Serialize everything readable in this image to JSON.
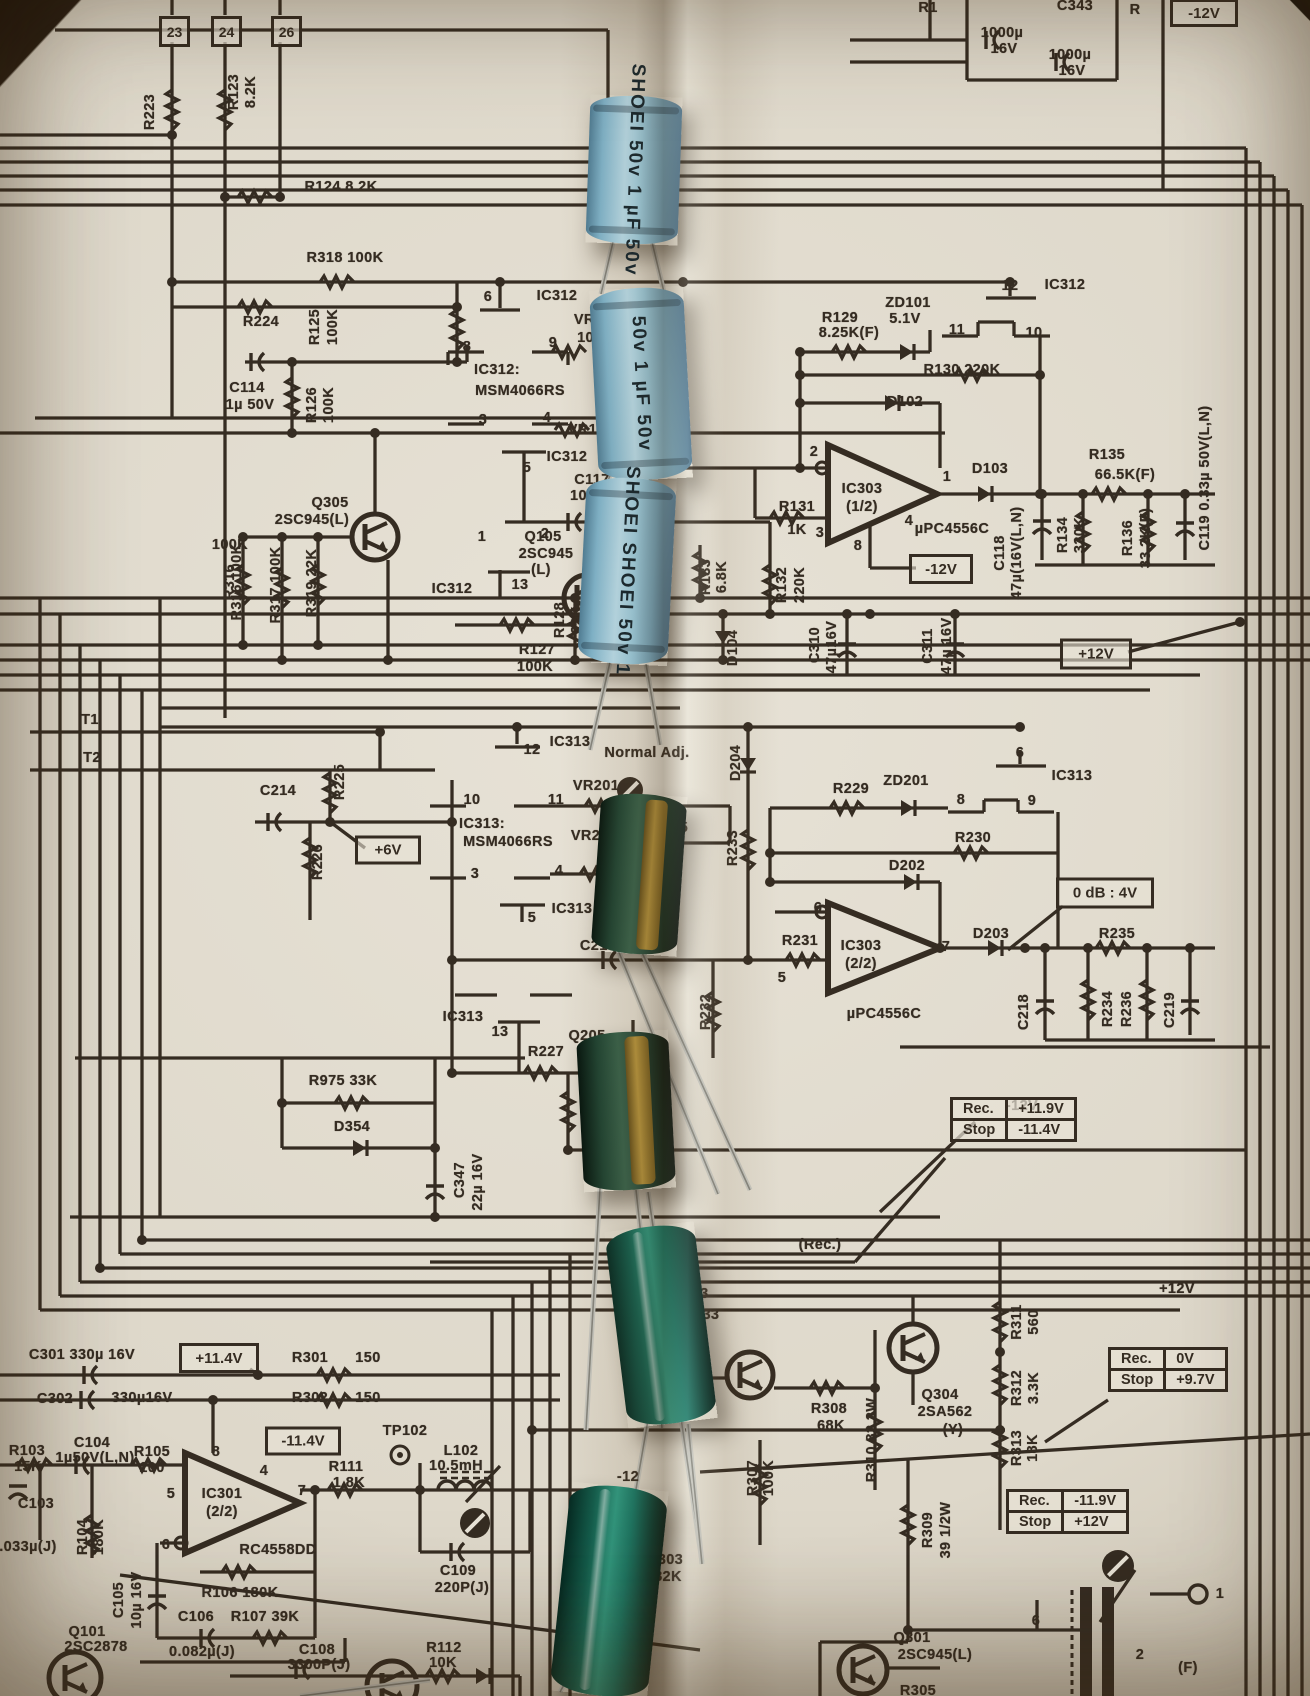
{
  "capacitor_markings": {
    "blue_brand": "SHOEI",
    "blue_value": "50v 1 µF",
    "blue_caps": [
      {
        "line1": "SHOEI",
        "line2": "50v 1 µF  50v"
      },
      {
        "line1": "50v 1 µF",
        "line2": "50v"
      },
      {
        "line1": "SHOEI  SHOEI",
        "line2": "50v 1"
      }
    ]
  },
  "schematic": {
    "terminals": [
      {
        "label": "23",
        "x": 159,
        "y": 16
      },
      {
        "label": "24",
        "x": 211,
        "y": 16
      },
      {
        "label": "26",
        "x": 271,
        "y": 16
      }
    ],
    "boxed_labels": [
      {
        "text": "-12V",
        "x": 1204,
        "y": 13,
        "w": 54,
        "h": 22
      },
      {
        "text": "-12V",
        "x": 941,
        "y": 569,
        "w": 50,
        "h": 24
      },
      {
        "text": "+12V",
        "x": 1096,
        "y": 654,
        "w": 58,
        "h": 25
      },
      {
        "text": "+6V",
        "x": 388,
        "y": 850,
        "w": 52,
        "h": 23
      },
      {
        "text": "0 dB : 4V",
        "x": 1105,
        "y": 893,
        "w": 84,
        "h": 25
      },
      {
        "text": "+11.4V",
        "x": 219,
        "y": 1358,
        "w": 66,
        "h": 24
      },
      {
        "text": "-11.4V",
        "x": 303,
        "y": 1441,
        "w": 62,
        "h": 23
      }
    ],
    "tables": [
      {
        "x": 950,
        "y": 1097,
        "rows": [
          [
            "Rec.",
            "+11.9V"
          ],
          [
            "Stop",
            "-11.4V"
          ]
        ]
      },
      {
        "x": 1108,
        "y": 1347,
        "rows": [
          [
            "Rec.",
            "0V"
          ],
          [
            "Stop",
            "+9.7V"
          ]
        ]
      },
      {
        "x": 1006,
        "y": 1489,
        "rows": [
          [
            "Rec.",
            "-11.9V"
          ],
          [
            "Stop",
            "+12V"
          ]
        ]
      }
    ],
    "labels": [
      [
        "R223",
        150,
        112,
        1
      ],
      [
        "R123",
        234,
        92,
        1
      ],
      [
        "8.2K",
        251,
        92,
        1
      ],
      [
        "R124 8.2K",
        341,
        187
      ],
      [
        "R318 100K",
        345,
        258
      ],
      [
        "R224",
        261,
        322
      ],
      [
        "R125",
        315,
        327,
        1
      ],
      [
        "100K",
        333,
        327,
        1
      ],
      [
        "C114",
        247,
        388
      ],
      [
        "1µ 50V",
        250,
        405
      ],
      [
        "R126",
        312,
        405,
        1
      ],
      [
        "100K",
        329,
        405,
        1
      ],
      [
        "R316",
        230,
        582,
        1
      ],
      [
        "100K",
        230,
        545,
        0,
        0
      ],
      [
        "R317 100K",
        276,
        585,
        1
      ],
      [
        "R319 22K",
        312,
        583,
        1
      ],
      [
        "R316 100K",
        237,
        582,
        1
      ],
      [
        "Q305",
        330,
        503
      ],
      [
        "2SC945(L)",
        312,
        520
      ],
      [
        "6",
        488,
        297
      ],
      [
        "IC312",
        557,
        296
      ],
      [
        "8",
        467,
        347
      ],
      [
        "9",
        553,
        343
      ],
      [
        "IC312:",
        497,
        370
      ],
      [
        "MSM4066RS",
        520,
        391
      ],
      [
        "3",
        483,
        420
      ],
      [
        "4",
        547,
        418
      ],
      [
        "VR101",
        597,
        320
      ],
      [
        "10K",
        591,
        338
      ],
      [
        "VR102 50K",
        607,
        430
      ],
      [
        "IC312",
        567,
        457
      ],
      [
        "5",
        527,
        468
      ],
      [
        "C117",
        592,
        480
      ],
      [
        "1000P",
        592,
        496
      ],
      [
        "(K)",
        614,
        510
      ],
      [
        "1",
        482,
        537
      ],
      [
        "2",
        545,
        534
      ],
      [
        "116",
        627,
        396
      ],
      [
        "50V",
        632,
        411
      ],
      [
        "12",
        1010,
        286
      ],
      [
        "IC312",
        1065,
        285
      ],
      [
        "ZD101",
        908,
        303
      ],
      [
        "5.1V",
        905,
        319
      ],
      [
        "R129",
        840,
        318
      ],
      [
        "8.25K(F)",
        849,
        333
      ],
      [
        "11",
        957,
        330
      ],
      [
        "10",
        1034,
        333
      ],
      [
        "R130 220K",
        962,
        370
      ],
      [
        "D102",
        905,
        402
      ],
      [
        "2",
        814,
        452
      ],
      [
        "IC303",
        862,
        489
      ],
      [
        "(1/2)",
        862,
        507
      ],
      [
        "1",
        947,
        477
      ],
      [
        "D103",
        990,
        469
      ],
      [
        "R131",
        797,
        507
      ],
      [
        "1K",
        797,
        530
      ],
      [
        "3",
        820,
        533
      ],
      [
        "4",
        909,
        521
      ],
      [
        "µPC4556C",
        952,
        529
      ],
      [
        "8",
        858,
        546
      ],
      [
        "R135",
        1107,
        455
      ],
      [
        "66.5K(F)",
        1125,
        475
      ],
      [
        "C118",
        1000,
        553,
        1
      ],
      [
        "47µ(16V(L,N)",
        1017,
        553,
        1
      ],
      [
        "R134",
        1063,
        535,
        1
      ],
      [
        "330K",
        1080,
        535,
        1
      ],
      [
        "R136",
        1128,
        538,
        1
      ],
      [
        "33.2K(F)",
        1146,
        538,
        1
      ],
      [
        "C119 0.33µ 50V(L,N)",
        1205,
        478,
        1
      ],
      [
        "Q105",
        543,
        537
      ],
      [
        "2SC945",
        546,
        554
      ],
      [
        "(L)",
        541,
        570
      ],
      [
        "IC312",
        452,
        589
      ],
      [
        "13",
        520,
        585
      ],
      [
        "R127",
        537,
        650
      ],
      [
        "100K",
        535,
        667
      ],
      [
        "R128",
        560,
        620,
        1
      ],
      [
        "22K",
        577,
        620,
        1
      ],
      [
        "R133",
        706,
        577,
        1
      ],
      [
        "6.8K",
        722,
        577,
        1
      ],
      [
        "R132",
        782,
        585,
        1
      ],
      [
        "220K",
        800,
        585,
        1
      ],
      [
        "D104",
        733,
        648,
        1
      ],
      [
        "C310",
        815,
        645,
        1
      ],
      [
        "47µ16V",
        832,
        647,
        1
      ],
      [
        "C311",
        928,
        646,
        1
      ],
      [
        "47µ 16V",
        947,
        646,
        1
      ],
      [
        "T1",
        90,
        720
      ],
      [
        "T2",
        92,
        758
      ],
      [
        "C214",
        278,
        791
      ],
      [
        "R225",
        340,
        782,
        1
      ],
      [
        "R226",
        318,
        862,
        1
      ],
      [
        "12",
        532,
        750
      ],
      [
        "IC313",
        570,
        742
      ],
      [
        "Normal Adj.",
        647,
        753
      ],
      [
        "IC313:",
        482,
        824
      ],
      [
        "MSM4066RS",
        508,
        842
      ],
      [
        "10",
        472,
        800
      ],
      [
        "11",
        556,
        800
      ],
      [
        "VR201",
        596,
        786
      ],
      [
        "VR202",
        594,
        836
      ],
      [
        "C215",
        670,
        828
      ],
      [
        "C216",
        662,
        853
      ],
      [
        "3",
        475,
        874
      ],
      [
        "4",
        559,
        871
      ],
      [
        "IC313",
        572,
        909
      ],
      [
        "5",
        532,
        918
      ],
      [
        "C217",
        598,
        946
      ],
      [
        "D204",
        736,
        763,
        1
      ],
      [
        "R233",
        733,
        848,
        1
      ],
      [
        "R229",
        851,
        789
      ],
      [
        "ZD201",
        906,
        781
      ],
      [
        "8",
        961,
        800
      ],
      [
        "9",
        1032,
        801
      ],
      [
        "6",
        1020,
        753
      ],
      [
        "IC313",
        1072,
        776
      ],
      [
        "R230",
        973,
        838
      ],
      [
        "D202",
        907,
        866
      ],
      [
        "6",
        818,
        908
      ],
      [
        "IC303",
        861,
        946
      ],
      [
        "(2/2)",
        861,
        964
      ],
      [
        "7",
        946,
        947
      ],
      [
        "D203",
        991,
        934
      ],
      [
        "µPC4556C",
        884,
        1014
      ],
      [
        "5",
        782,
        978
      ],
      [
        "R231",
        800,
        941
      ],
      [
        "R232",
        706,
        1012,
        1
      ],
      [
        "R235",
        1117,
        934
      ],
      [
        "C218",
        1024,
        1012,
        1
      ],
      [
        "R234",
        1108,
        1009,
        1
      ],
      [
        "R236",
        1127,
        1009,
        1
      ],
      [
        "C219",
        1170,
        1010,
        1
      ],
      [
        "IC313",
        463,
        1017
      ],
      [
        "13",
        500,
        1032
      ],
      [
        "Q205",
        587,
        1036
      ],
      [
        "R227",
        546,
        1052
      ],
      [
        "R228",
        588,
        1114,
        1
      ],
      [
        "R975 33K",
        343,
        1081
      ],
      [
        "D354",
        352,
        1127
      ],
      [
        "C347",
        460,
        1180,
        1
      ],
      [
        "22µ 16V",
        478,
        1182,
        1
      ],
      [
        "(Rec.)",
        820,
        1245
      ],
      [
        "-12V",
        1022,
        1106
      ],
      [
        "+12V",
        1177,
        1289
      ],
      [
        "Q303",
        690,
        1294
      ],
      [
        "2SA733",
        692,
        1315
      ],
      [
        "R308",
        829,
        1409
      ],
      [
        "68K",
        831,
        1426
      ],
      [
        "R310 82 2W",
        872,
        1440,
        1
      ],
      [
        "Q304",
        940,
        1395
      ],
      [
        "2SA562",
        945,
        1412
      ],
      [
        "(Y)",
        953,
        1430
      ],
      [
        "R307",
        753,
        1478,
        1
      ],
      [
        "100K",
        769,
        1478,
        1
      ],
      [
        "R311",
        1017,
        1322,
        1
      ],
      [
        "560",
        1034,
        1322,
        1
      ],
      [
        "R312",
        1017,
        1388,
        1
      ],
      [
        "3.3K",
        1034,
        1388,
        1
      ],
      [
        "R313",
        1017,
        1448,
        1
      ],
      [
        "18K",
        1033,
        1448,
        1
      ],
      [
        "R309",
        928,
        1530,
        1
      ],
      [
        "39 1/2W",
        946,
        1530,
        1
      ],
      [
        "Q301",
        912,
        1638
      ],
      [
        "2SC945(L)",
        935,
        1655
      ],
      [
        "R305",
        918,
        1691
      ],
      [
        "6",
        1036,
        1621
      ],
      [
        "2",
        1140,
        1655
      ],
      [
        "1",
        1220,
        1594
      ],
      [
        "(F)",
        1188,
        1668
      ],
      [
        "R303",
        665,
        1560
      ],
      [
        "82K",
        668,
        1577
      ],
      [
        "C301 330µ 16V",
        82,
        1355
      ],
      [
        "R301",
        310,
        1358
      ],
      [
        "150",
        368,
        1358
      ],
      [
        "C302",
        55,
        1399
      ],
      [
        "330µ16V",
        142,
        1398
      ],
      [
        "R302",
        310,
        1398
      ],
      [
        "150",
        368,
        1398
      ],
      [
        "R103",
        27,
        1451
      ],
      [
        "15K",
        28,
        1467
      ],
      [
        "C104",
        92,
        1443
      ],
      [
        "1µ50V(L,N)",
        95,
        1458
      ],
      [
        "R105",
        152,
        1452
      ],
      [
        "100",
        152,
        1468
      ],
      [
        "TP102",
        405,
        1431
      ],
      [
        "L102",
        461,
        1451
      ],
      [
        "10.5mH",
        456,
        1466
      ],
      [
        "R111",
        346,
        1467
      ],
      [
        "1.8K",
        349,
        1483
      ],
      [
        "8",
        216,
        1452
      ],
      [
        "4",
        264,
        1471
      ],
      [
        "5",
        171,
        1494
      ],
      [
        "6",
        166,
        1545
      ],
      [
        "7",
        302,
        1491
      ],
      [
        "IC301",
        222,
        1494
      ],
      [
        "(2/2)",
        222,
        1512
      ],
      [
        "RC4558DD",
        278,
        1550
      ],
      [
        "C103",
        36,
        1504
      ],
      [
        ".033µ(J)",
        28,
        1547
      ],
      [
        "R104",
        83,
        1537,
        1
      ],
      [
        "180K",
        99,
        1537,
        1
      ],
      [
        "C105",
        119,
        1600,
        1
      ],
      [
        "10µ 16V",
        137,
        1600,
        1
      ],
      [
        "R106  180K",
        240,
        1593
      ],
      [
        "C106",
        196,
        1617
      ],
      [
        "R107  39K",
        265,
        1617
      ],
      [
        "0.082µ(J)",
        202,
        1652
      ],
      [
        "Q101",
        87,
        1632
      ],
      [
        "2SC2878",
        96,
        1647
      ],
      [
        "C108",
        317,
        1650
      ],
      [
        "3300P(J)",
        319,
        1665
      ],
      [
        "C109",
        458,
        1571
      ],
      [
        "220P(J)",
        462,
        1588
      ],
      [
        "R112",
        444,
        1648
      ],
      [
        "10K",
        443,
        1663
      ],
      [
        "-12",
        628,
        1477
      ],
      [
        "C343",
        1075,
        6
      ],
      [
        "1000µ",
        1002,
        33
      ],
      [
        "16V",
        1004,
        49
      ],
      [
        "1000µ",
        1070,
        55
      ],
      [
        "16V",
        1072,
        71
      ],
      [
        "R1",
        928,
        8
      ],
      [
        "R",
        1135,
        10
      ]
    ]
  }
}
